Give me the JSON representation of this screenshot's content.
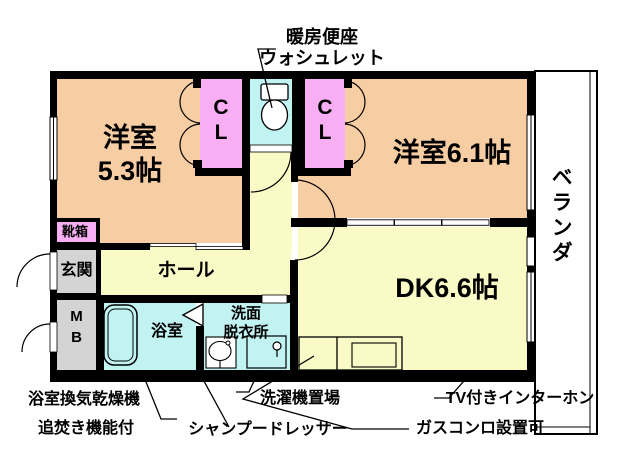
{
  "colors": {
    "room_peach": "#f7cda4",
    "closet_pink": "#f7aef2",
    "water_cyan": "#c2f3f3",
    "floor_yellow": "#fafac6",
    "entry_gray": "#d4d4d4",
    "wall_black": "#000000",
    "background": "#ffffff"
  },
  "rooms": {
    "western53": {
      "line1": "洋室",
      "line2": "5.3帖"
    },
    "western61": {
      "label": "洋室6.1帖"
    },
    "dk": {
      "label": "DK6.6帖"
    },
    "hall": {
      "label": "ホール"
    },
    "entrance": {
      "label": "玄関"
    },
    "shoebox": {
      "label": "靴箱"
    },
    "meterbox": {
      "line1": "M",
      "line2": "B"
    },
    "bathroom": {
      "label": "浴室"
    },
    "washroom": {
      "line1": "洗面",
      "line2": "脱衣所"
    },
    "closet_left": {
      "line1": "C",
      "line2": "L"
    },
    "closet_right": {
      "line1": "C",
      "line2": "L"
    },
    "veranda": {
      "label": "ベランダ"
    }
  },
  "annotations": {
    "toilet_note": {
      "line1": "暖房便座",
      "line2": "ウォシュレット"
    },
    "bath_note1": "浴室換気乾燥機",
    "bath_note2": "追焚き機能付",
    "laundry_note": "洗濯機置場",
    "shampoo_note": "シャンプードレッサー",
    "intercom_note": "TV付きインターホン",
    "gas_note": "ガスコンロ設置可"
  }
}
